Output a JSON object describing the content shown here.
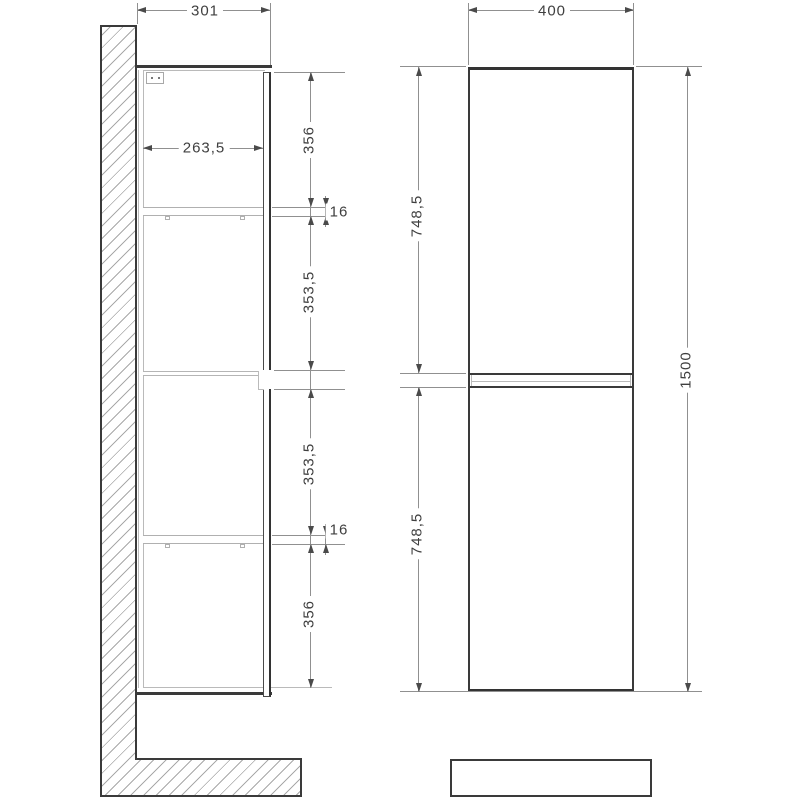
{
  "drawing": {
    "type": "cabinet-technical-drawing",
    "side_view": {
      "depth": "301",
      "inner_depth": "263,5",
      "segments": {
        "top": "356",
        "shelf_top": "16",
        "upper_mid": "353,5",
        "lower_mid": "353,5",
        "shelf_bottom": "16",
        "bottom": "356"
      }
    },
    "front_view": {
      "width": "400",
      "upper_door": "748,5",
      "lower_door": "748,5",
      "total_height": "1500"
    },
    "colors": {
      "outline": "#3a3a3a",
      "dimension_line": "#909090",
      "light_line": "#bababa",
      "hatch": "#a9a9a9",
      "text": "#3f3f3f",
      "background": "#ffffff"
    }
  }
}
